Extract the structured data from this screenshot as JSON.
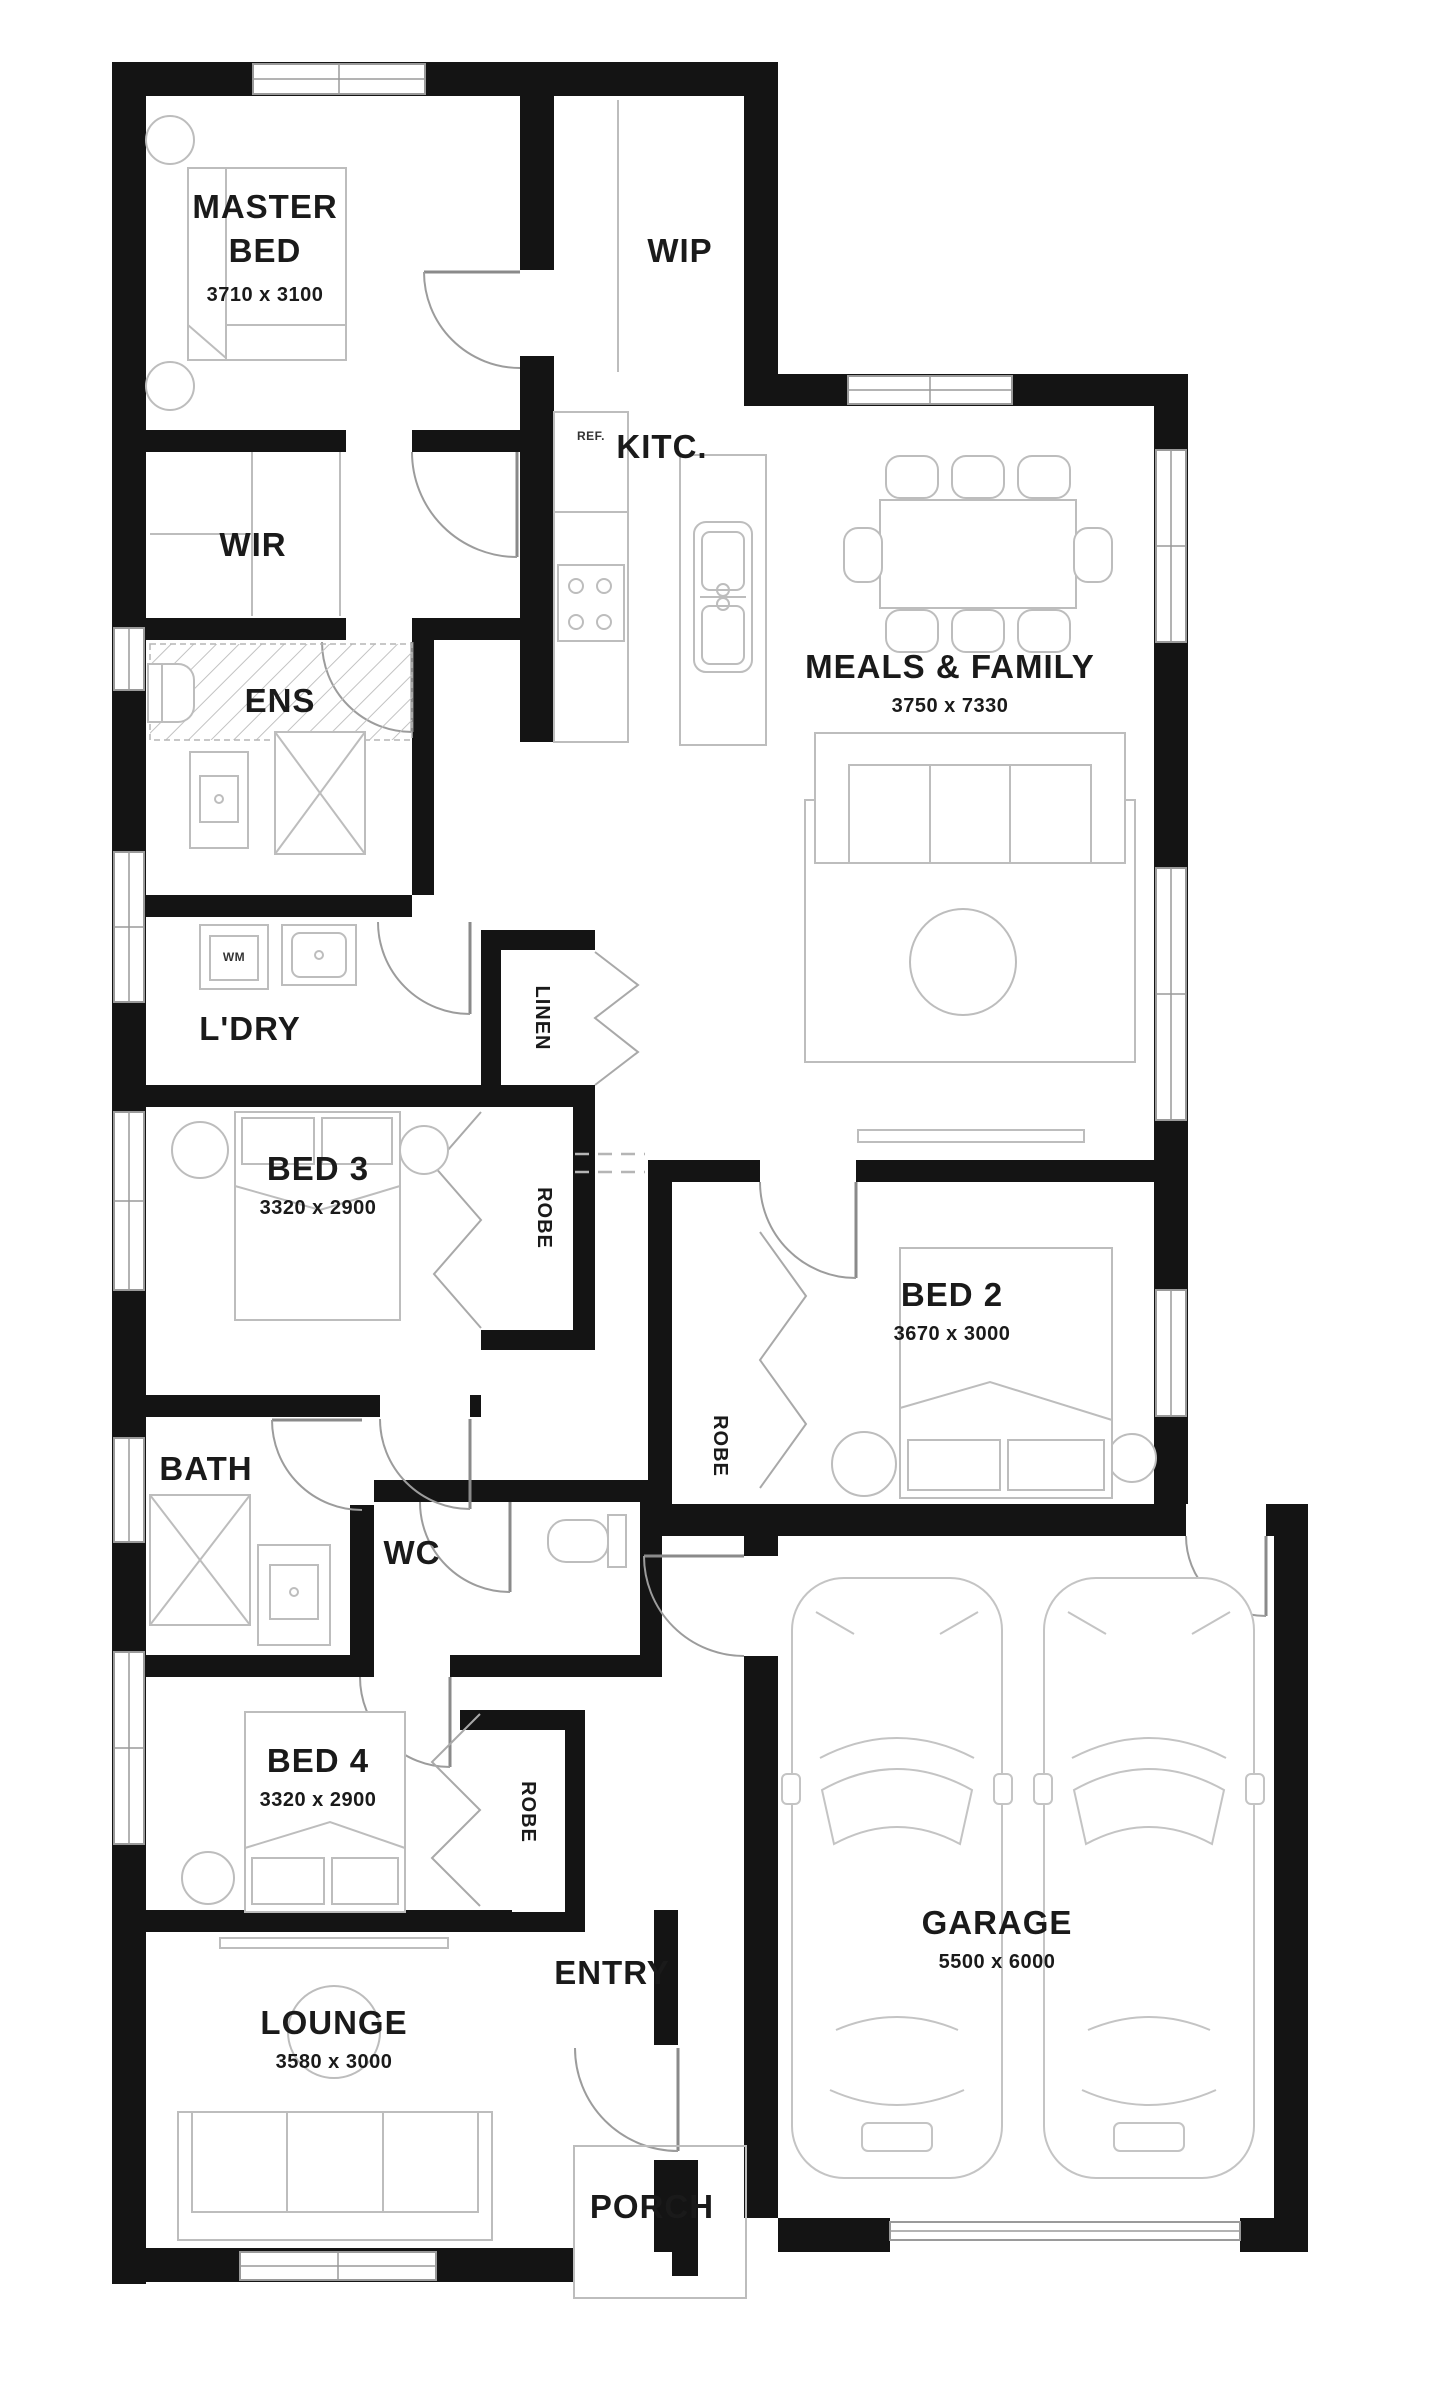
{
  "title": "Single storey house floor plan",
  "colors": {
    "wall": "#141414",
    "furniture_line": "#bdbdbd",
    "door_line": "#9c9c9c",
    "window_line": "#9a9a9a",
    "text": "#1a1a1a",
    "background": "#ffffff"
  },
  "labels": {
    "master_line1": "MASTER",
    "master_line2": "BED",
    "master_dims": "3710 x 3100",
    "wip": "WIP",
    "kitchen": "KITC.",
    "fridge": "REF.",
    "meals": "MEALS & FAMILY",
    "meals_dims": "3750 x 7330",
    "wir": "WIR",
    "ens": "ENS",
    "laundry": "L'DRY",
    "washer": "WM",
    "linen": "LINEN",
    "bed3": "BED 3",
    "bed3_dims": "3320 x 2900",
    "bed3_robe": "ROBE",
    "bed2": "BED 2",
    "bed2_dims": "3670 x 3000",
    "bed2_robe": "ROBE",
    "bath": "BATH",
    "wc": "WC",
    "bed4": "BED 4",
    "bed4_dims": "3320 x 2900",
    "bed4_robe": "ROBE",
    "entry": "ENTRY",
    "lounge": "LOUNGE",
    "lounge_dims": "3580 x 3000",
    "garage": "GARAGE",
    "garage_dims": "5500 x 6000",
    "porch": "PORCH"
  },
  "rooms": [
    {
      "name": "MASTER BED",
      "dims": "3710 x 3100"
    },
    {
      "name": "WIP"
    },
    {
      "name": "KITC."
    },
    {
      "name": "MEALS & FAMILY",
      "dims": "3750 x 7330"
    },
    {
      "name": "WIR"
    },
    {
      "name": "ENS"
    },
    {
      "name": "L'DRY"
    },
    {
      "name": "BED 3",
      "dims": "3320 x 2900"
    },
    {
      "name": "BED 2",
      "dims": "3670 x 3000"
    },
    {
      "name": "BATH"
    },
    {
      "name": "WC"
    },
    {
      "name": "BED 4",
      "dims": "3320 x 2900"
    },
    {
      "name": "ENTRY"
    },
    {
      "name": "LOUNGE",
      "dims": "3580 x 3000"
    },
    {
      "name": "GARAGE",
      "dims": "5500 x 6000"
    },
    {
      "name": "PORCH"
    }
  ]
}
